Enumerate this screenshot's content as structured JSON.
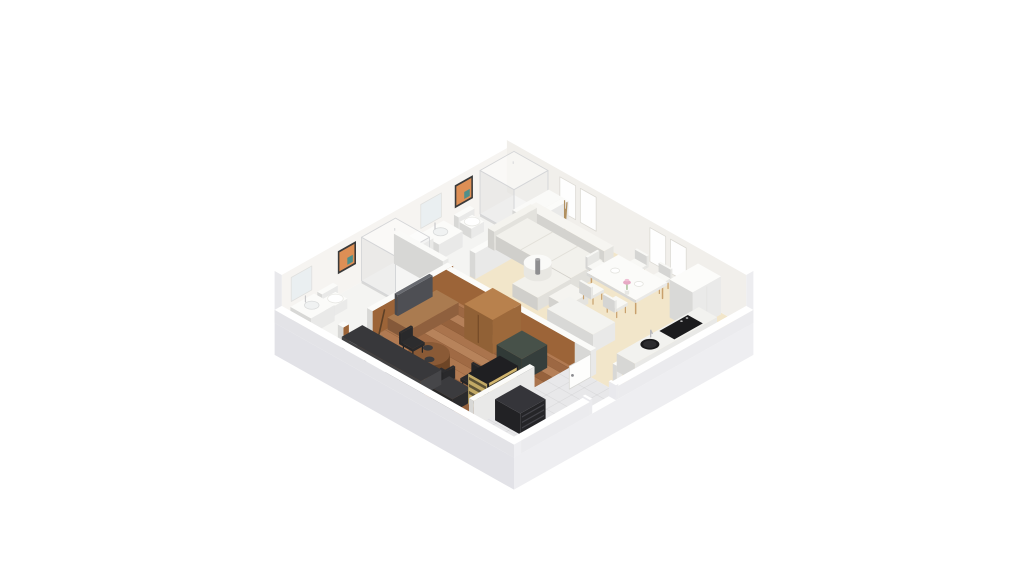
{
  "meta": {
    "description": "3D isometric dollhouse render of a one-bedroom apartment floor plan on a white background",
    "background": "#ffffff"
  },
  "projection": {
    "cx": 514,
    "cy": 196,
    "S": 0.79,
    "T": 0.445
  },
  "palette": {
    "wall_top": "#ffffff",
    "wall_nw_inner": "#f6f4f1",
    "wall_ne_inner": "#f1efeb",
    "wood_wall": "#9c6438",
    "beige_floor": "#f2e6ca",
    "wood_floor": "#a9734c",
    "bath_floor": "#f4f4f2",
    "tile_floor": "#e8e8ea",
    "glass": "#d4d5d7",
    "art_orange": "#dd8f55",
    "art_teal": "#4f8f8a"
  },
  "scene": [
    {
      "n": "base-slab",
      "t": "slab",
      "u0": -9,
      "v0": -9,
      "u1": 294,
      "v1": 294,
      "depth": 32,
      "top": "#ffffff",
      "se": "#eeeef1",
      "sw": "#e2e2e7"
    },
    {
      "n": "floor-living-dining",
      "t": "floor",
      "u": 62,
      "v": 0,
      "w": 223,
      "d": 155,
      "fill": "#f2e6ca"
    },
    {
      "n": "floor-bedroom-wood",
      "t": "floor",
      "u": 69,
      "v": 148,
      "w": 159,
      "d": 137,
      "fill": "#a9734c",
      "planks": {
        "step": 10.5,
        "colors": [
          "#b17a52",
          "#9d6843",
          "#b58059",
          "#96623d",
          "#aa744d",
          "#b7835b",
          "#a06a44",
          "#ad774f"
        ]
      }
    },
    {
      "n": "floor-hallway-tile",
      "t": "floor",
      "u": 228,
      "v": 155,
      "w": 57,
      "d": 130,
      "fill": "#e8e8ea",
      "grid": 16
    },
    {
      "n": "floor-bathroom-2",
      "t": "floor",
      "u": 0,
      "v": 0,
      "w": 62,
      "d": 148,
      "fill": "#f4f4f2"
    },
    {
      "n": "floor-bathroom-1",
      "t": "floor",
      "u": 0,
      "v": 148,
      "w": 62,
      "d": 137,
      "fill": "#f4f4f2"
    },
    {
      "n": "wall-northwest",
      "t": "box",
      "u": -9,
      "v": -9,
      "w": 9,
      "d": 303,
      "h": 52,
      "fill": "#ffffff",
      "top": "#ffffff",
      "right": "#f6f4f1",
      "left": "#e9e9ec"
    },
    {
      "n": "wall-northeast",
      "t": "box",
      "u": -9,
      "v": -9,
      "w": 303,
      "d": 9,
      "h": 52,
      "fill": "#ffffff",
      "top": "#ffffff",
      "right": "#ededf0",
      "left": "#f1efeb"
    },
    {
      "n": "window-1",
      "t": "decalV",
      "v": 0,
      "u0": 58,
      "u1": 78,
      "z0": 11,
      "z1": 45,
      "fill": "#fefefe",
      "stroke": "#dcdad4"
    },
    {
      "n": "window-2",
      "t": "decalV",
      "v": 0,
      "u0": 84,
      "u1": 104,
      "z0": 11,
      "z1": 45,
      "fill": "#fefefe",
      "stroke": "#dcdad4"
    },
    {
      "n": "window-3",
      "t": "decalV",
      "v": 0,
      "u0": 172,
      "u1": 192,
      "z0": 11,
      "z1": 45,
      "fill": "#fefefe",
      "stroke": "#dcdad4"
    },
    {
      "n": "window-4",
      "t": "decalV",
      "v": 0,
      "u0": 198,
      "u1": 218,
      "z0": 11,
      "z1": 45,
      "fill": "#fefefe",
      "stroke": "#dcdad4"
    },
    {
      "n": "shower-bathroom-2",
      "t": "shower",
      "u": 1.5,
      "v": 1.5,
      "w": 43,
      "d": 43,
      "h": 46
    },
    {
      "n": "shower-side-wall",
      "t": "box",
      "u": 44,
      "v": 0,
      "w": 18,
      "d": 46,
      "h": 26,
      "fill": "#fafaf8"
    },
    {
      "n": "wall-art-bathroom-2",
      "t": "decalU",
      "u": 0,
      "v0": 52,
      "v1": 75,
      "z0": 21,
      "z1": 44,
      "fill": "#dd8f55",
      "frame": "#3a3a3a",
      "accent": "#4f8f8a"
    },
    {
      "n": "toilet-bathroom-2-tank",
      "t": "box",
      "u": 1,
      "v": 57,
      "w": 6,
      "d": 20,
      "h": 16,
      "fill": "#fbfbf9"
    },
    {
      "n": "toilet-bathroom-2-bowl",
      "t": "box",
      "u": 6,
      "v": 59,
      "w": 15,
      "d": 16,
      "h": 10,
      "fill": "#fcfcfa"
    },
    {
      "n": "toilet-bathroom-2-seat",
      "t": "disc",
      "u": 14,
      "v": 67,
      "z": 10.5,
      "r": 7,
      "fill": "#ffffff",
      "stroke": "#e8e8e4"
    },
    {
      "n": "vanity-bathroom-2",
      "t": "box",
      "u": 1,
      "v": 90,
      "w": 24,
      "d": 30,
      "h": 16,
      "fill": "#fbfbf9"
    },
    {
      "n": "basin-bathroom-2",
      "t": "disc",
      "u": 12,
      "v": 105,
      "z": 16.3,
      "r": 6.5,
      "fill": "#f0f2f2",
      "stroke": "#d9dbdb"
    },
    {
      "n": "faucet-bathroom-2",
      "t": "line3",
      "pts": [
        [
          5,
          105,
          16
        ],
        [
          5,
          105,
          22
        ]
      ],
      "stroke": "#c9c9cb",
      "w": 1.2
    },
    {
      "n": "mirror-bathroom-2",
      "t": "decalU",
      "u": 0,
      "v0": 92,
      "v1": 118,
      "z0": 20,
      "z1": 44,
      "fill": "#eaeff1",
      "stroke": "#e0e0de"
    },
    {
      "n": "cabinet-bathroom-2",
      "t": "box",
      "u": 2,
      "v": 122,
      "w": 18,
      "d": 20,
      "h": 21,
      "fill": "#fafaf8"
    },
    {
      "n": "shower-bathroom-1",
      "t": "shower",
      "u": 1.5,
      "v": 151.5,
      "w": 43,
      "d": 43,
      "h": 46
    },
    {
      "n": "wall-art-bathroom-1",
      "t": "decalU",
      "u": 0,
      "v0": 200,
      "v1": 223,
      "z0": 21,
      "z1": 44,
      "fill": "#dd8f55",
      "frame": "#3a3a3a",
      "accent": "#4f8f8a"
    },
    {
      "n": "toilet-bathroom-1-tank",
      "t": "box",
      "u": 1,
      "v": 230,
      "w": 6,
      "d": 20,
      "h": 16,
      "fill": "#fbfbf9"
    },
    {
      "n": "toilet-bathroom-1-bowl",
      "t": "box",
      "u": 6,
      "v": 232,
      "w": 15,
      "d": 16,
      "h": 10,
      "fill": "#fcfcfa"
    },
    {
      "n": "toilet-bathroom-1-seat",
      "t": "disc",
      "u": 14,
      "v": 240,
      "z": 10.5,
      "r": 7,
      "fill": "#ffffff",
      "stroke": "#e8e8e4"
    },
    {
      "n": "vanity-bathroom-1",
      "t": "box",
      "u": 1,
      "v": 254,
      "w": 26,
      "d": 30,
      "h": 16,
      "fill": "#fbfbf9"
    },
    {
      "n": "basin-bathroom-1",
      "t": "disc",
      "u": 13,
      "v": 269,
      "z": 16.3,
      "r": 6.5,
      "fill": "#f0f2f2",
      "stroke": "#d9dbdb"
    },
    {
      "n": "faucet-bathroom-1",
      "t": "line3",
      "pts": [
        [
          5,
          269,
          16
        ],
        [
          5,
          269,
          22
        ]
      ],
      "stroke": "#c9c9cb",
      "w": 1.2
    },
    {
      "n": "mirror-bathroom-1",
      "t": "decalU",
      "u": 0,
      "v0": 256,
      "v1": 282,
      "z0": 20,
      "z1": 44,
      "fill": "#eaeff1",
      "stroke": "#e0e0de"
    },
    {
      "n": "wall-bathroom-divider",
      "t": "box",
      "u": 0,
      "v": 145,
      "w": 62,
      "d": 7,
      "h": 30,
      "fill": "#fafaf8"
    },
    {
      "n": "wall-bathroom-front-a",
      "t": "box",
      "u": 62,
      "v": 0,
      "w": 7,
      "d": 118,
      "h": 26,
      "fill": "#fbfbf9"
    },
    {
      "n": "wall-bathroom-front-b",
      "t": "box",
      "u": 62,
      "v": 146,
      "w": 7,
      "d": 102,
      "h": 26,
      "fill": "#fbfbf9",
      "right": "#9c6438"
    },
    {
      "n": "wall-bathroom-front-c",
      "t": "box",
      "u": 62,
      "v": 278,
      "w": 7,
      "d": 7,
      "h": 26,
      "fill": "#fbfbf9",
      "right": "#9c6438"
    },
    {
      "n": "coat-rack",
      "t": "rack",
      "u": 76,
      "v": 12
    },
    {
      "n": "sofa-backrest",
      "t": "box",
      "u": 48,
      "v": 20,
      "w": 98,
      "d": 12,
      "h": 24,
      "fill": "#f6f5f1"
    },
    {
      "n": "sofa-armrest",
      "t": "box",
      "u": 41,
      "v": 20,
      "w": 8,
      "d": 54,
      "h": 19,
      "fill": "#f4f3ee"
    },
    {
      "n": "sofa-seat",
      "t": "box",
      "u": 49,
      "v": 32,
      "w": 95,
      "d": 40,
      "h": 14,
      "fill": "#f2f1ec"
    },
    {
      "n": "sofa-seam-1",
      "t": "flat",
      "u": 80,
      "v": 32,
      "w": 1.2,
      "d": 40,
      "z": 14.05,
      "fill": "#e2e0d9"
    },
    {
      "n": "sofa-seam-2",
      "t": "flat",
      "u": 112,
      "v": 32,
      "w": 1.2,
      "d": 40,
      "z": 14.05,
      "fill": "#e2e0d9"
    },
    {
      "n": "sofa-chaise",
      "t": "box",
      "u": 112,
      "v": 72,
      "w": 32,
      "d": 42,
      "h": 13,
      "fill": "#f2f1ec"
    },
    {
      "n": "sofa-ottoman",
      "t": "box",
      "u": 146,
      "v": 74,
      "w": 22,
      "d": 28,
      "h": 10,
      "fill": "#f5f4f0"
    },
    {
      "n": "coffee-table",
      "t": "cyl",
      "u": 102,
      "v": 72,
      "r": 12.5,
      "h": 11,
      "fill": "#fafaf8",
      "side": "#e8e7e2"
    },
    {
      "n": "coffee-table-item",
      "t": "cyl",
      "u": 102,
      "v": 72,
      "r": 2.2,
      "h": 14,
      "fill": "#a8a8aa",
      "side": "#8e8e90"
    },
    {
      "n": "dining-chair-1",
      "t": "chair",
      "u": 158,
      "v": 5,
      "w": 15,
      "d": 14,
      "back": "v-",
      "fill": "#f8f8f5",
      "leg": "#c8a06c"
    },
    {
      "n": "dining-chair-2",
      "t": "chair",
      "u": 188,
      "v": 5,
      "w": 15,
      "d": 14,
      "back": "v-",
      "fill": "#f8f8f5",
      "leg": "#c8a06c"
    },
    {
      "n": "dining-chair-3",
      "t": "chair",
      "u": 137,
      "v": 29,
      "w": 14,
      "d": 15,
      "back": "u-",
      "fill": "#f8f8f5",
      "leg": "#c8a06c"
    },
    {
      "n": "dining-table",
      "t": "table",
      "u": 150,
      "v": 18,
      "w": 62,
      "d": 40,
      "h": 16,
      "top": "#fbfbf9",
      "leg": "#c8a06c"
    },
    {
      "n": "plate-1",
      "t": "disc",
      "u": 166,
      "v": 38,
      "z": 16.2,
      "r": 4,
      "fill": "#ffffff",
      "stroke": "#e4e4df"
    },
    {
      "n": "plate-2",
      "t": "disc",
      "u": 196,
      "v": 38,
      "z": 16.2,
      "r": 4,
      "fill": "#ffffff",
      "stroke": "#e4e4df"
    },
    {
      "n": "flower-vase",
      "t": "flowers",
      "u": 181,
      "v": 38
    },
    {
      "n": "dining-chair-4",
      "t": "chair",
      "u": 158,
      "v": 59,
      "w": 15,
      "d": 14,
      "back": "v+",
      "fill": "#f8f8f5",
      "leg": "#c8a06c"
    },
    {
      "n": "dining-chair-5",
      "t": "chair",
      "u": 188,
      "v": 59,
      "w": 15,
      "d": 14,
      "back": "v+",
      "fill": "#f8f8f5",
      "leg": "#c8a06c"
    },
    {
      "n": "kitchen-island",
      "t": "box",
      "u": 168,
      "v": 98,
      "w": 58,
      "d": 28,
      "h": 18,
      "fill": "#fbfbf9",
      "top": "#f3f3f0"
    },
    {
      "n": "wall-bedroom-brown",
      "t": "box",
      "u": 69,
      "v": 148,
      "w": 163,
      "d": 7,
      "h": 26,
      "fill": "#fbfbf9",
      "left": "#9c6438"
    },
    {
      "n": "wall-hall-white",
      "t": "box",
      "u": 232,
      "v": 148,
      "w": 20,
      "d": 7,
      "h": 26,
      "fill": "#fbfbf9"
    },
    {
      "n": "wall-hall-white-2",
      "t": "box",
      "u": 280,
      "v": 148,
      "w": 5,
      "d": 7,
      "h": 26,
      "fill": "#fbfbf9"
    },
    {
      "n": "hallway-door",
      "t": "decalU",
      "u": 252,
      "v0": 155,
      "v1": 182,
      "z0": 0,
      "z1": 23,
      "fill": "#fdfdfc",
      "stroke": "#d6d6d3"
    },
    {
      "n": "hallway-door-handle",
      "t": "dot",
      "u": 252,
      "v": 178,
      "z": 12,
      "r": 1.4,
      "fill": "#8a8a8e"
    },
    {
      "n": "tv-stand",
      "t": "box",
      "u": 70,
      "v": 168,
      "w": 28,
      "d": 62,
      "h": 12,
      "fill": "#9a6743",
      "top": "#aa7b50"
    },
    {
      "n": "tv",
      "t": "box",
      "u": 71,
      "v": 178,
      "w": 4,
      "d": 44,
      "h": 21,
      "z0": 12,
      "fill": "#54555a",
      "top": "#686a70"
    },
    {
      "n": "guitar",
      "t": "guitar",
      "u": 74,
      "v": 244
    },
    {
      "n": "wardrobe",
      "t": "box",
      "u": 128,
      "v": 155,
      "w": 36,
      "d": 36,
      "h": 34,
      "fill": "#a9713f",
      "top": "#b8814d"
    },
    {
      "n": "wardrobe-door-seam",
      "t": "decalV",
      "v": 191,
      "u0": 145,
      "u1": 146.5,
      "z0": 3,
      "z1": 31,
      "fill": "#744a27"
    },
    {
      "n": "dark-cabinet",
      "t": "box",
      "u": 182,
      "v": 172,
      "w": 32,
      "d": 32,
      "h": 23,
      "fill": "#394340",
      "top": "#475149"
    },
    {
      "n": "bistro-table",
      "t": "cyl",
      "u": 138,
      "v": 246,
      "r": 19,
      "h": 13,
      "fill": "#8a5a36",
      "side": "#6d4526"
    },
    {
      "n": "bowl-1",
      "t": "disc",
      "u": 131,
      "v": 240,
      "z": 13.3,
      "r": 4.5,
      "fill": "#3a3a3c"
    },
    {
      "n": "bowl-2",
      "t": "disc",
      "u": 145,
      "v": 252,
      "z": 13.3,
      "r": 4.5,
      "fill": "#3a3a3c"
    },
    {
      "n": "black-chair-1",
      "t": "chair",
      "u": 104,
      "v": 232,
      "w": 15,
      "d": 15,
      "back": "u-",
      "fill": "#2c2c2e",
      "leg": "#202022"
    },
    {
      "n": "black-chair-2",
      "t": "chair",
      "u": 158,
      "v": 250,
      "w": 15,
      "d": 15,
      "back": "u+",
      "fill": "#2c2c2e",
      "leg": "#202022"
    },
    {
      "n": "desk-chair",
      "t": "chair",
      "u": 182,
      "v": 236,
      "w": 14,
      "d": 14,
      "back": "v-",
      "fill": "#2a2a2c",
      "leg": "#202022"
    },
    {
      "n": "desk",
      "t": "box",
      "u": 176,
      "v": 258,
      "w": 28,
      "d": 24,
      "h": 13,
      "fill": "#2e2e30",
      "top": "#3b3b3e"
    },
    {
      "n": "kitchenette-counter",
      "t": "box",
      "u": 66,
      "v": 258,
      "w": 100,
      "d": 26,
      "h": 15,
      "fill": "#4b4b4e",
      "top": "#38383b"
    },
    {
      "n": "kitchenette-front-1",
      "t": "decalV",
      "v": 284,
      "u0": 70,
      "u1": 94,
      "z0": 0,
      "z1": 11,
      "fill": "#f1f1ef"
    },
    {
      "n": "kitchenette-front-2",
      "t": "decalV",
      "v": 284,
      "u0": 97,
      "u1": 121,
      "z0": 0,
      "z1": 11,
      "fill": "#f1f1ef"
    },
    {
      "n": "shelving-unit",
      "t": "shelf",
      "u": 204,
      "v": 222,
      "w": 24,
      "d": 40,
      "h": 30,
      "frame": "#1f1f22",
      "fill": "#e2c476"
    },
    {
      "n": "wall-bedroom-hall",
      "t": "box",
      "u": 228,
      "v": 208,
      "w": 6,
      "d": 77,
      "h": 26,
      "fill": "#fbfbf9"
    },
    {
      "n": "black-dresser",
      "t": "box",
      "u": 240,
      "v": 232,
      "w": 32,
      "d": 32,
      "h": 21,
      "fill": "#28282b",
      "top": "#35353a"
    },
    {
      "n": "dresser-drawer-1",
      "t": "decalU",
      "u": 272,
      "v0": 234,
      "v1": 262,
      "z0": 5,
      "z1": 6.4,
      "fill": "#434349"
    },
    {
      "n": "dresser-drawer-2",
      "t": "decalU",
      "u": 272,
      "v0": 234,
      "v1": 262,
      "z0": 10.5,
      "z1": 11.9,
      "fill": "#434349"
    },
    {
      "n": "dresser-drawer-3",
      "t": "decalU",
      "u": 272,
      "v0": 234,
      "v1": 262,
      "z0": 16,
      "z1": 17.4,
      "fill": "#434349"
    },
    {
      "n": "tall-cabinet",
      "t": "box",
      "u": 235,
      "v": 2,
      "w": 29,
      "d": 36,
      "h": 38,
      "fill": "#fcfcfa"
    },
    {
      "n": "tall-cabinet-seam",
      "t": "decalU",
      "u": 264,
      "v0": 19.5,
      "v1": 20.5,
      "z0": 2,
      "z1": 36,
      "fill": "#e3e3e0"
    },
    {
      "n": "kitchen-counter",
      "t": "box",
      "u": 262,
      "v": 28,
      "w": 23,
      "d": 104,
      "h": 18,
      "fill": "#fafaf8",
      "top": "#f2f2ef"
    },
    {
      "n": "cooktop",
      "t": "flat",
      "u": 264,
      "v": 44,
      "w": 19,
      "d": 36,
      "z": 18.1,
      "fill": "#1b1b1d"
    },
    {
      "n": "cooktop-knob-1",
      "t": "disc",
      "u": 267,
      "v": 48,
      "z": 18.2,
      "r": 1.2,
      "fill": "#cfcfcf"
    },
    {
      "n": "cooktop-knob-2",
      "t": "disc",
      "u": 267,
      "v": 55,
      "z": 18.2,
      "r": 1.2,
      "fill": "#cfcfcf"
    },
    {
      "n": "kitchen-sink",
      "t": "disc",
      "u": 273,
      "v": 101,
      "z": 18.2,
      "r": 8.5,
      "fill": "#1a1a1c"
    },
    {
      "n": "kitchen-sink-inner",
      "t": "disc",
      "u": 273,
      "v": 101,
      "z": 18.2,
      "r": 6,
      "fill": "#2c2c2f"
    },
    {
      "n": "kitchen-faucet",
      "t": "line3",
      "pts": [
        [
          265,
          92,
          18
        ],
        [
          265,
          92,
          25
        ],
        [
          270,
          95,
          25
        ]
      ],
      "stroke": "#b9b9bd",
      "w": 1.3
    },
    {
      "n": "wall-front-se-a",
      "t": "box",
      "u": 285,
      "v": -9,
      "w": 9,
      "d": 171,
      "h": 13,
      "fill": "#ffffff",
      "right": "#ebebee",
      "left": "#e9e9ed"
    },
    {
      "n": "front-door-jamb-1",
      "t": "box",
      "u": 285,
      "v": 162,
      "w": 9,
      "d": 3,
      "h": 15,
      "fill": "#ffffff",
      "right": "#ebebee",
      "left": "#e9e9ed"
    },
    {
      "n": "front-door-jamb-2",
      "t": "box",
      "u": 285,
      "v": 195,
      "w": 9,
      "d": 3,
      "h": 15,
      "fill": "#ffffff",
      "right": "#ebebee",
      "left": "#e9e9ed"
    },
    {
      "n": "wall-front-se-b",
      "t": "box",
      "u": 285,
      "v": 198,
      "w": 9,
      "d": 96,
      "h": 13,
      "fill": "#ffffff",
      "right": "#ebebee",
      "left": "#e9e9ed"
    },
    {
      "n": "wall-front-sw",
      "t": "box",
      "u": -9,
      "v": 285,
      "w": 303,
      "d": 9,
      "h": 13,
      "fill": "#ffffff",
      "right": "#efeff2",
      "left": "#e3e3e7"
    }
  ]
}
